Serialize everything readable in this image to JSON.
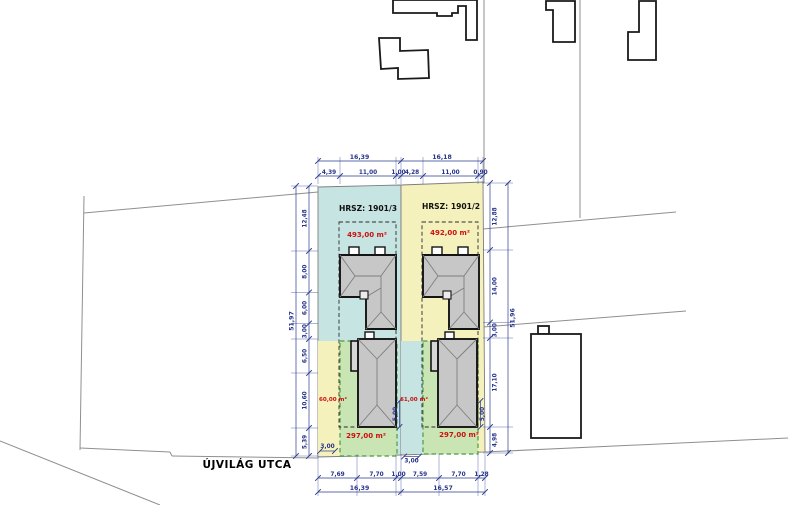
{
  "plan": {
    "street_label": "ÚJVILÁG UTCA",
    "lots": [
      {
        "parcel_label": "HRSZ: 1901/3",
        "parcel_area": "493,00 m²",
        "garden_area": "297,00 m²",
        "paved_area": "60,00 m²"
      },
      {
        "parcel_label": "HRSZ: 1901/2",
        "parcel_area": "492,00 m²",
        "garden_area": "297,00 m²",
        "paved_area": "61,00 m²"
      }
    ],
    "dimensions": {
      "top_totals": [
        "16,39",
        "16,18"
      ],
      "top_segments": [
        "4,39",
        "11,00",
        "1,00",
        "4,28",
        "11,00",
        "0,90"
      ],
      "left_chain": [
        "12,48",
        "8,00",
        "6,00",
        "3,00",
        "6,50",
        "10,60",
        "5,39"
      ],
      "left_total": [
        "51,97"
      ],
      "right_chain": [
        "12,88",
        "14,00",
        "3,00",
        "17,10",
        "4,98"
      ],
      "right_total": [
        "51,96"
      ],
      "bottom_segments": [
        "7,69",
        "7,70",
        "1,00",
        "7,59",
        "7,70",
        "1,28"
      ],
      "bottom_totals": [
        "16,39",
        "16,57"
      ],
      "inner_left": "3,00",
      "inner_middle": "3,00",
      "setback_left": "5,00",
      "setback_right": "5,00"
    },
    "colors": {
      "lot_left": "#c6e4e2",
      "lot_right": "#f5f1bc",
      "garden": "#c9e5b3",
      "garden_border": "#4e9a3e",
      "dimension": "#2a3b8f",
      "area_text": "#cc1111",
      "roof": "#c7c7c7"
    }
  }
}
